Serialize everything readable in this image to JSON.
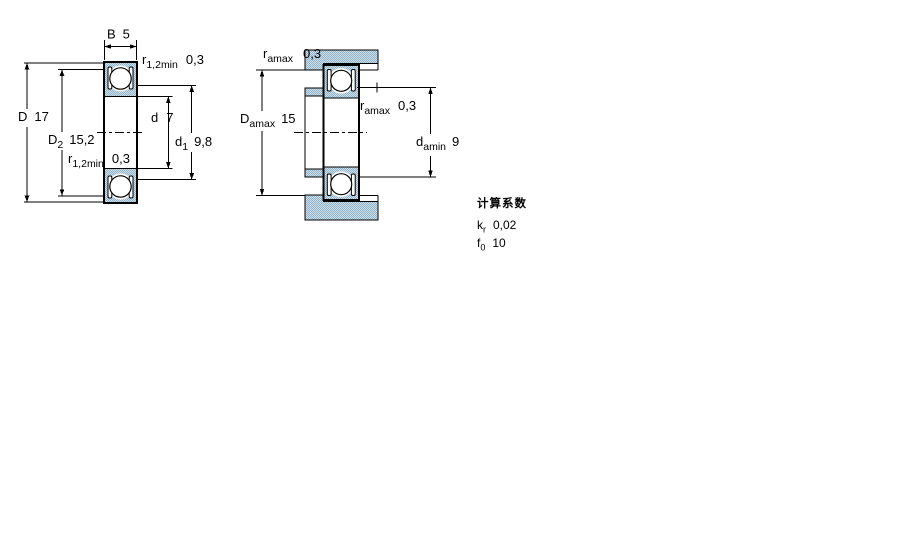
{
  "colors": {
    "line": "#000000",
    "text": "#000000",
    "hatch_base": "#cfe0ea",
    "hatch_dot": "#8fb2c9",
    "background": "#ffffff"
  },
  "views": {
    "left": {
      "dims": {
        "B": {
          "label": "B",
          "value": "5"
        },
        "r12_top": {
          "label": "r",
          "sub": "1,2min",
          "value": "0,3"
        },
        "D": {
          "label": "D",
          "value": "17"
        },
        "D2": {
          "label": "D",
          "sub": "2",
          "value": "15,2"
        },
        "d": {
          "label": "d",
          "value": "7"
        },
        "d1": {
          "label": "d",
          "sub": "1",
          "value": "9,8"
        },
        "r12_bottom": {
          "label": "r",
          "sub": "1,2min",
          "value": "0,3"
        }
      }
    },
    "right": {
      "dims": {
        "ra_top": {
          "label": "r",
          "sub": "amax",
          "value": "0,3"
        },
        "Da": {
          "label": "D",
          "sub": "amax",
          "value": "15"
        },
        "ra_mid": {
          "label": "r",
          "sub": "amax",
          "value": "0,3"
        },
        "da": {
          "label": "d",
          "sub": "amin",
          "value": "9"
        }
      }
    }
  },
  "calculation_factors": {
    "heading": "计算系数",
    "rows": [
      {
        "label": "k",
        "sub": "r",
        "value": "0,02"
      },
      {
        "label": "f",
        "sub": "0",
        "value": "10"
      }
    ]
  }
}
